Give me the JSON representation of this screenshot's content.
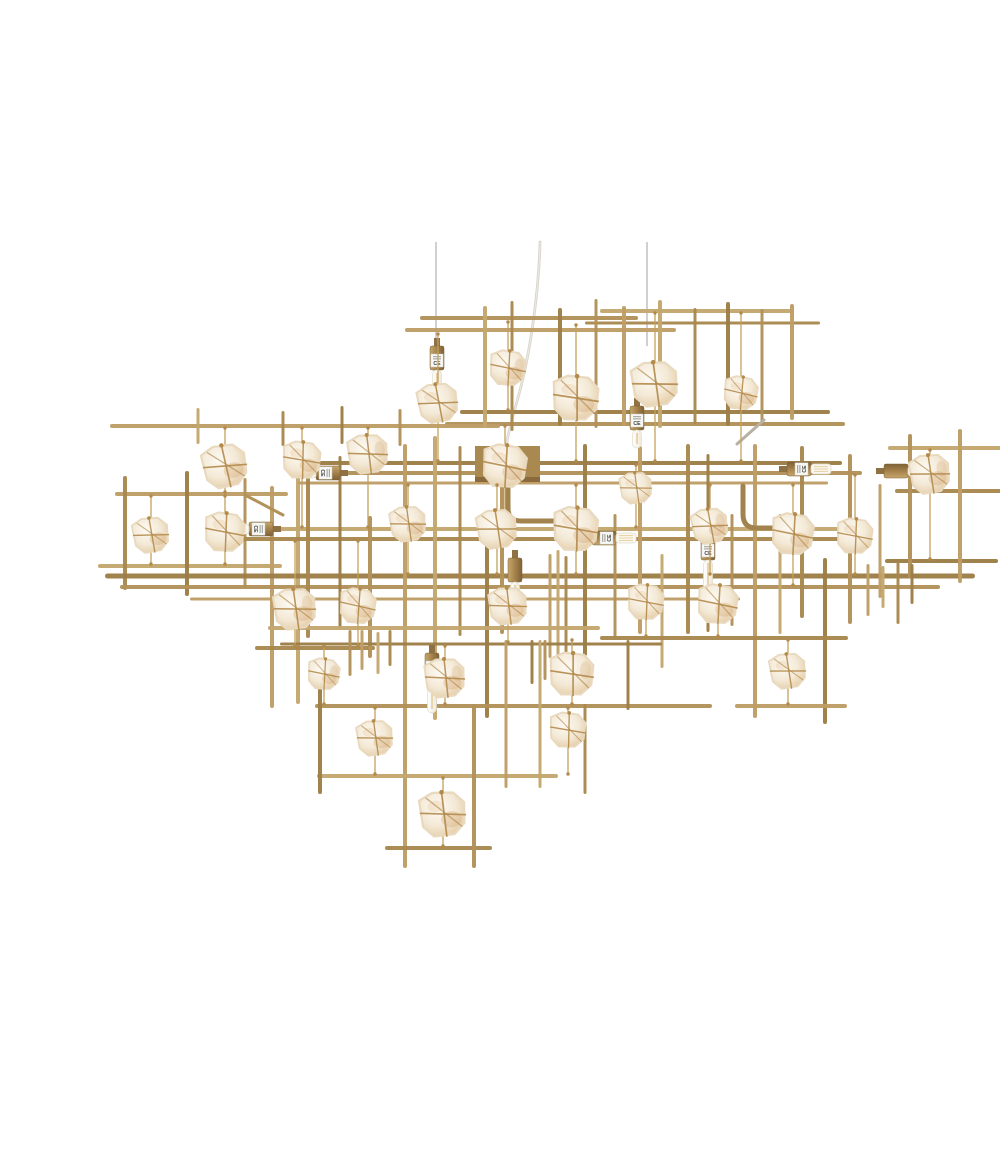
{
  "image": {
    "kind": "product-photo",
    "description": "Large rectangular antique-gold metal chandelier built from an irregular lattice of thin brass rods, hung from three thin wires and a central cord; raw quartz stones wrapped in twine hang inside the grid cells and several brass bulb sockets with small CE stickers hold clear tube and LED bulbs, on a plain white background.",
    "background": "#ffffff",
    "width": 1000,
    "height": 1125
  },
  "labels": {
    "certification": "CE"
  },
  "palette": {
    "rods": [
      "#b3925a",
      "#a98850",
      "#bf9e66",
      "#9d7e47",
      "#c3a770"
    ],
    "silver": "#b7b0a3",
    "wire": "#bcbcbc",
    "cord": "#d8d4cb",
    "cord_hi": "#f1efe9",
    "twine": "#b28a4a",
    "string": "#c3a05e",
    "amber1": "#cf9a63",
    "amber2": "#e3bd8d",
    "canopy": "#a9894f",
    "canopy_edge": "#8a6a3b",
    "pipe": "#a2834e",
    "label_bg": "#f7f7f4",
    "label_edge": "#c9c9c2",
    "label_text_color": "#3c3c3c",
    "label_fineprint": "#9a9a94",
    "glass_fill": "#faf7ee",
    "glass_edge": "#e0dccd",
    "filament": "#d9b36a",
    "stone_core": "#fdfaf4",
    "stone_mid": "#f3e9d6",
    "stone_edge": "#e3c9a1",
    "stone_stroke": "#e8d9bf",
    "brass_hi": "#c6a76e",
    "brass_mid": "#a8854e",
    "brass_lo": "#7e6136",
    "neck": "#8f7243"
  },
  "scene": {
    "wires": [
      {
        "x": 396,
        "y1": 226,
        "y2": 330
      },
      {
        "x": 607,
        "y1": 226,
        "y2": 330
      }
    ],
    "cord_path": "M500 226 C499 272 491 334 479 378 C472 404 467 420 466 433",
    "canopy": {
      "x": 435,
      "y": 430,
      "w": 65,
      "h": 36
    },
    "pipes": [
      "M468 470 L468 492 Q468 505 481 505 L530 505",
      "M703 470 L703 498 Q703 512 716 512 L734 512"
    ],
    "rods": [
      [
        380,
        302,
        598,
        302,
        4
      ],
      [
        365,
        314,
        636,
        314,
        4
      ],
      [
        560,
        295,
        752,
        295,
        4
      ],
      [
        545,
        307,
        780,
        307,
        3
      ],
      [
        420,
        396,
        790,
        396,
        4
      ],
      [
        405,
        408,
        805,
        408,
        4
      ],
      [
        70,
        410,
        460,
        410,
        4
      ],
      [
        445,
        290,
        445,
        412,
        4
      ],
      [
        472,
        285,
        472,
        415,
        3
      ],
      [
        520,
        292,
        520,
        410,
        4
      ],
      [
        556,
        283,
        556,
        412,
        3
      ],
      [
        584,
        290,
        584,
        410,
        4
      ],
      [
        620,
        284,
        620,
        412,
        4
      ],
      [
        655,
        292,
        655,
        408,
        3
      ],
      [
        688,
        286,
        688,
        410,
        4
      ],
      [
        722,
        293,
        722,
        406,
        3
      ],
      [
        752,
        288,
        752,
        404,
        4
      ],
      [
        158,
        392,
        158,
        428,
        3
      ],
      [
        243,
        395,
        243,
        430,
        3
      ],
      [
        302,
        390,
        302,
        428,
        3
      ],
      [
        360,
        393,
        360,
        430,
        3
      ],
      [
        75,
        478,
        248,
        478,
        4
      ],
      [
        58,
        550,
        242,
        550,
        4
      ],
      [
        85,
        460,
        85,
        574,
        4
      ],
      [
        147,
        455,
        147,
        580,
        4
      ],
      [
        205,
        462,
        205,
        572,
        3
      ],
      [
        232,
        470,
        232,
        692,
        4
      ],
      [
        258,
        428,
        258,
        688,
        4
      ],
      [
        215,
        632,
        335,
        632,
        4
      ],
      [
        268,
        447,
        802,
        447,
        4
      ],
      [
        250,
        457,
        822,
        457,
        4
      ],
      [
        258,
        467,
        788,
        467,
        3
      ],
      [
        200,
        513,
        812,
        513,
        4
      ],
      [
        190,
        523,
        832,
        523,
        4
      ],
      [
        65,
        560,
        935,
        560,
        5
      ],
      [
        80,
        571,
        900,
        571,
        4
      ],
      [
        150,
        583,
        700,
        583,
        3
      ],
      [
        848,
        432,
        998,
        432,
        4
      ],
      [
        855,
        475,
        998,
        475,
        4
      ],
      [
        845,
        545,
        958,
        545,
        4
      ],
      [
        870,
        418,
        870,
        562,
        4
      ],
      [
        920,
        413,
        920,
        567,
        4
      ],
      [
        962,
        424,
        962,
        548,
        3
      ],
      [
        268,
        430,
        268,
        622,
        4
      ],
      [
        300,
        440,
        300,
        612,
        3
      ],
      [
        330,
        500,
        330,
        642,
        4
      ],
      [
        365,
        428,
        365,
        852,
        4
      ],
      [
        395,
        420,
        395,
        704,
        4
      ],
      [
        420,
        430,
        420,
        620,
        3
      ],
      [
        447,
        500,
        447,
        702,
        4
      ],
      [
        462,
        428,
        462,
        618,
        4
      ],
      [
        510,
        538,
        510,
        642,
        3
      ],
      [
        518,
        534,
        518,
        646,
        3
      ],
      [
        526,
        540,
        526,
        638,
        3
      ],
      [
        545,
        428,
        545,
        640,
        4
      ],
      [
        575,
        498,
        575,
        622,
        3
      ],
      [
        600,
        430,
        600,
        618,
        4
      ],
      [
        622,
        538,
        622,
        652,
        3
      ],
      [
        648,
        428,
        648,
        618,
        4
      ],
      [
        668,
        438,
        668,
        616,
        3
      ],
      [
        692,
        498,
        692,
        610,
        3
      ],
      [
        715,
        428,
        715,
        702,
        4
      ],
      [
        740,
        498,
        740,
        618,
        3
      ],
      [
        762,
        430,
        762,
        602,
        4
      ],
      [
        785,
        542,
        785,
        708,
        4
      ],
      [
        810,
        438,
        810,
        608,
        4
      ],
      [
        840,
        468,
        840,
        582,
        3
      ],
      [
        228,
        612,
        560,
        612,
        4
      ],
      [
        560,
        622,
        808,
        622,
        4
      ],
      [
        240,
        628,
        622,
        628,
        3
      ],
      [
        275,
        690,
        672,
        690,
        4
      ],
      [
        695,
        690,
        807,
        690,
        4
      ],
      [
        277,
        760,
        518,
        760,
        4
      ],
      [
        345,
        832,
        452,
        832,
        4
      ],
      [
        280,
        648,
        280,
        778,
        4
      ],
      [
        434,
        688,
        434,
        852,
        4
      ],
      [
        466,
        624,
        466,
        772,
        3
      ],
      [
        500,
        624,
        500,
        772,
        3
      ],
      [
        545,
        688,
        545,
        778,
        3
      ],
      [
        588,
        624,
        588,
        694,
        3
      ],
      [
        310,
        614,
        310,
        660,
        3
      ],
      [
        322,
        614,
        322,
        654,
        3
      ],
      [
        338,
        616,
        338,
        658,
        3
      ],
      [
        350,
        614,
        350,
        650,
        3
      ],
      [
        492,
        624,
        492,
        668,
        3
      ],
      [
        505,
        624,
        505,
        664,
        3
      ],
      [
        828,
        548,
        828,
        600,
        3
      ],
      [
        843,
        550,
        843,
        592,
        3
      ],
      [
        858,
        546,
        858,
        608,
        3
      ],
      [
        872,
        548,
        872,
        588,
        3
      ],
      [
        205,
        479,
        243,
        499,
        3,
        "g"
      ],
      [
        697,
        428,
        724,
        404,
        3,
        "s"
      ]
    ],
    "sockets": [
      {
        "x": 397,
        "y": 338,
        "dir": "down",
        "bulb": "tube-short",
        "label": true
      },
      {
        "x": 597,
        "y": 398,
        "dir": "down",
        "bulb": "tube-short",
        "label": true
      },
      {
        "x": 292,
        "y": 457,
        "dir": "left",
        "bulb": "led",
        "label": true
      },
      {
        "x": 225,
        "y": 513,
        "dir": "left",
        "bulb": "led",
        "label": true
      },
      {
        "x": 755,
        "y": 453,
        "dir": "right",
        "bulb": "led",
        "label": true
      },
      {
        "x": 560,
        "y": 522,
        "dir": "right",
        "bulb": "led",
        "label": true
      },
      {
        "x": 475,
        "y": 550,
        "dir": "down",
        "bulb": "tube",
        "label": false
      },
      {
        "x": 668,
        "y": 528,
        "dir": "down",
        "bulb": "tube-long",
        "label": true
      },
      {
        "x": 392,
        "y": 645,
        "dir": "down",
        "bulb": "tube-long",
        "label": true
      },
      {
        "x": 852,
        "y": 455,
        "dir": "right",
        "bulb": "led",
        "label": false
      }
    ],
    "stones": [
      [
        398,
        387,
        40,
        -8,
        318,
        445
      ],
      [
        468,
        352,
        36,
        6,
        306,
        394
      ],
      [
        536,
        382,
        46,
        3,
        309,
        445
      ],
      [
        615,
        368,
        46,
        -5,
        297,
        445
      ],
      [
        701,
        377,
        34,
        8,
        297,
        445
      ],
      [
        890,
        458,
        40,
        -6,
        434,
        543
      ],
      [
        815,
        520,
        36,
        5,
        459,
        558
      ],
      [
        185,
        450,
        44,
        -10,
        412,
        476
      ],
      [
        262,
        444,
        38,
        4,
        412,
        511
      ],
      [
        328,
        438,
        40,
        -4,
        412,
        511
      ],
      [
        465,
        450,
        44,
        6,
        410,
        511
      ],
      [
        111,
        519,
        36,
        -7,
        480,
        548
      ],
      [
        185,
        516,
        40,
        5,
        480,
        548
      ],
      [
        255,
        593,
        42,
        -5,
        525,
        630
      ],
      [
        318,
        590,
        36,
        7,
        525,
        630
      ],
      [
        457,
        513,
        40,
        -6,
        469,
        558
      ],
      [
        536,
        513,
        45,
        4,
        469,
        558
      ],
      [
        670,
        510,
        36,
        -8,
        469,
        558
      ],
      [
        596,
        472,
        32,
        -5,
        449,
        511
      ],
      [
        753,
        518,
        42,
        6,
        469,
        569
      ],
      [
        368,
        508,
        36,
        -5,
        469,
        558
      ],
      [
        532,
        658,
        44,
        3,
        624,
        688
      ],
      [
        468,
        590,
        38,
        -4,
        573,
        626
      ],
      [
        678,
        588,
        40,
        6,
        573,
        620
      ],
      [
        748,
        655,
        36,
        -6,
        624,
        688
      ],
      [
        405,
        662,
        40,
        -3,
        630,
        688
      ],
      [
        335,
        722,
        36,
        -5,
        692,
        758
      ],
      [
        528,
        714,
        36,
        4,
        692,
        758
      ],
      [
        403,
        798,
        46,
        -4,
        762,
        830
      ],
      [
        284,
        658,
        32,
        6,
        630,
        688
      ],
      [
        606,
        586,
        36,
        5,
        573,
        620
      ]
    ]
  }
}
